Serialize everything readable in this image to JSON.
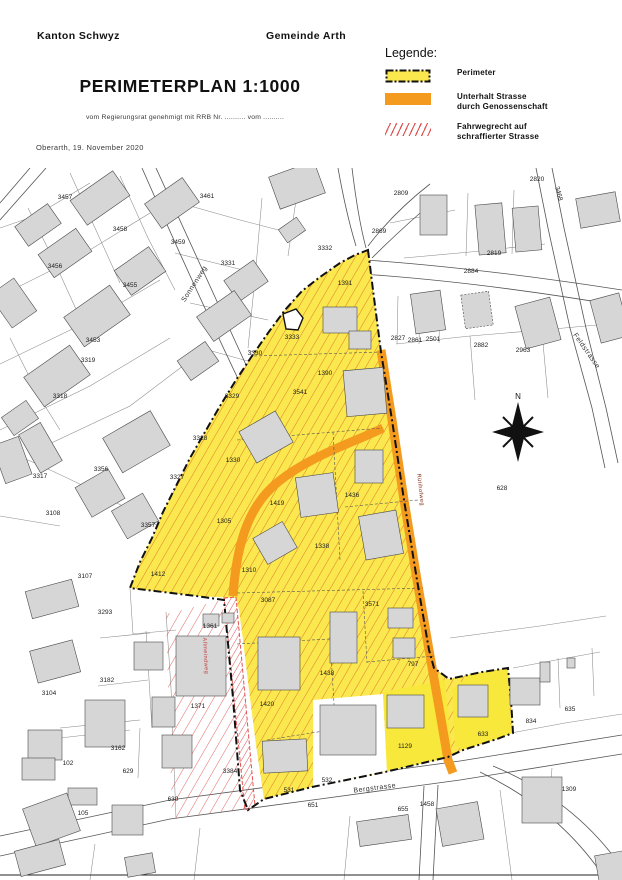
{
  "header": {
    "canton": "Kanton Schwyz",
    "municipality": "Gemeinde Arth",
    "title": "PERIMETERPLAN 1:1000",
    "approval_note": "vom Regierungsrat genehmigt mit RRB Nr. .......... vom ..........",
    "place_date": "Oberarth, 19. November 2020"
  },
  "legend": {
    "title": "Legende:",
    "items": [
      {
        "label": "Perimeter"
      },
      {
        "line1": "Unterhalt Strasse",
        "line2": "durch Genossenschaft"
      },
      {
        "line1": "Fahrwegrecht auf",
        "line2": "schraffierter Strasse"
      }
    ]
  },
  "map": {
    "compass_label": "N",
    "streets": [
      {
        "name": "Sonnenweg",
        "x": 196,
        "y": 117,
        "rot": -57,
        "cls": ""
      },
      {
        "name": "Bergstrasse",
        "x": 375,
        "y": 622,
        "rot": -7,
        "cls": ""
      },
      {
        "name": "Feldstrasse",
        "x": 585,
        "y": 184,
        "rot": 55,
        "cls": ""
      },
      {
        "name": "Allmeindweg",
        "x": 204,
        "y": 488,
        "rot": 87,
        "cls": "red"
      },
      {
        "name": "Rütihofweg",
        "x": 419,
        "y": 322,
        "rot": 84,
        "cls": "dred"
      }
    ],
    "parcels": [
      {
        "n": "3457",
        "x": 65,
        "y": 31
      },
      {
        "n": "3461",
        "x": 207,
        "y": 30
      },
      {
        "n": "3458",
        "x": 120,
        "y": 63
      },
      {
        "n": "3459",
        "x": 178,
        "y": 76
      },
      {
        "n": "3456",
        "x": 55,
        "y": 100
      },
      {
        "n": "3331",
        "x": 228,
        "y": 97
      },
      {
        "n": "3455",
        "x": 130,
        "y": 119
      },
      {
        "n": "3453",
        "x": 93,
        "y": 174
      },
      {
        "n": "3319",
        "x": 88,
        "y": 194
      },
      {
        "n": "3318",
        "x": 60,
        "y": 230
      },
      {
        "n": "3330",
        "x": 255,
        "y": 187
      },
      {
        "n": "3329",
        "x": 232,
        "y": 230
      },
      {
        "n": "3541",
        "x": 300,
        "y": 226
      },
      {
        "n": "3332",
        "x": 325,
        "y": 82
      },
      {
        "n": "1391",
        "x": 345,
        "y": 117
      },
      {
        "n": "1390",
        "x": 325,
        "y": 207
      },
      {
        "n": "2809",
        "x": 401,
        "y": 27
      },
      {
        "n": "2869",
        "x": 379,
        "y": 65
      },
      {
        "n": "2820",
        "x": 537,
        "y": 13
      },
      {
        "n": "2819",
        "x": 494,
        "y": 87
      },
      {
        "n": "2884",
        "x": 471,
        "y": 105
      },
      {
        "n": "2827",
        "x": 398,
        "y": 172
      },
      {
        "n": "2861",
        "x": 415,
        "y": 174
      },
      {
        "n": "2501",
        "x": 433,
        "y": 173
      },
      {
        "n": "2882",
        "x": 481,
        "y": 179
      },
      {
        "n": "2963",
        "x": 523,
        "y": 184
      },
      {
        "n": "3317",
        "x": 40,
        "y": 310
      },
      {
        "n": "3108",
        "x": 53,
        "y": 347
      },
      {
        "n": "3107",
        "x": 85,
        "y": 410
      },
      {
        "n": "3104",
        "x": 49,
        "y": 527
      },
      {
        "n": "3293",
        "x": 105,
        "y": 446
      },
      {
        "n": "3327",
        "x": 177,
        "y": 311
      },
      {
        "n": "3328",
        "x": 200,
        "y": 272
      },
      {
        "n": "3356",
        "x": 101,
        "y": 303
      },
      {
        "n": "3357",
        "x": 148,
        "y": 359
      },
      {
        "n": "1412",
        "x": 158,
        "y": 408
      },
      {
        "n": "1330",
        "x": 233,
        "y": 294
      },
      {
        "n": "1305",
        "x": 224,
        "y": 355
      },
      {
        "n": "1419",
        "x": 277,
        "y": 337
      },
      {
        "n": "1310",
        "x": 249,
        "y": 404
      },
      {
        "n": "1338",
        "x": 322,
        "y": 380
      },
      {
        "n": "1436",
        "x": 352,
        "y": 329
      },
      {
        "n": "1438",
        "x": 327,
        "y": 507
      },
      {
        "n": "3087",
        "x": 268,
        "y": 434
      },
      {
        "n": "3571",
        "x": 372,
        "y": 438
      },
      {
        "n": "797",
        "x": 413,
        "y": 498
      },
      {
        "n": "1420",
        "x": 267,
        "y": 538
      },
      {
        "n": "1361",
        "x": 210,
        "y": 460
      },
      {
        "n": "1371",
        "x": 198,
        "y": 540
      },
      {
        "n": "3384",
        "x": 230,
        "y": 605
      },
      {
        "n": "102",
        "x": 68,
        "y": 597
      },
      {
        "n": "629",
        "x": 128,
        "y": 605
      },
      {
        "n": "630",
        "x": 173,
        "y": 633
      },
      {
        "n": "105",
        "x": 83,
        "y": 647
      },
      {
        "n": "3182",
        "x": 107,
        "y": 514
      },
      {
        "n": "3162",
        "x": 118,
        "y": 582
      },
      {
        "n": "651",
        "x": 313,
        "y": 639
      },
      {
        "n": "532",
        "x": 327,
        "y": 614
      },
      {
        "n": "531",
        "x": 289,
        "y": 624
      },
      {
        "n": "655",
        "x": 403,
        "y": 643
      },
      {
        "n": "1458",
        "x": 427,
        "y": 638
      },
      {
        "n": "1129",
        "x": 405,
        "y": 580
      },
      {
        "n": "633",
        "x": 483,
        "y": 568
      },
      {
        "n": "834",
        "x": 531,
        "y": 555
      },
      {
        "n": "635",
        "x": 570,
        "y": 543
      },
      {
        "n": "1309",
        "x": 569,
        "y": 623
      },
      {
        "n": "628",
        "x": 502,
        "y": 322
      },
      {
        "n": "3333",
        "x": 292,
        "y": 171
      },
      {
        "n": "3468",
        "x": 557,
        "y": 26,
        "rot": 75
      }
    ]
  },
  "colors": {
    "perimeter_fill": "#FAE84E",
    "bright_parcel_fill": "#F8E83C",
    "orange_road": "#F49B1F",
    "hatch_orange": "#E07A28",
    "red_hatch": "#E05252",
    "building_gray": "#D6D6D6"
  }
}
